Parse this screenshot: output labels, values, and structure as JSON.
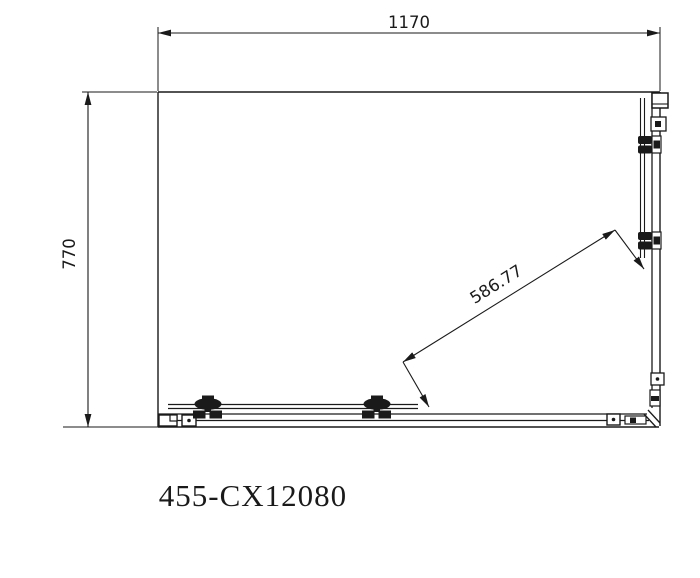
{
  "product": {
    "code": "455-CX12080"
  },
  "dimensions": {
    "width": "1170",
    "depth": "770",
    "diagonal": "586.77"
  },
  "colors": {
    "line": "#1a1a1a",
    "background": "#ffffff"
  }
}
